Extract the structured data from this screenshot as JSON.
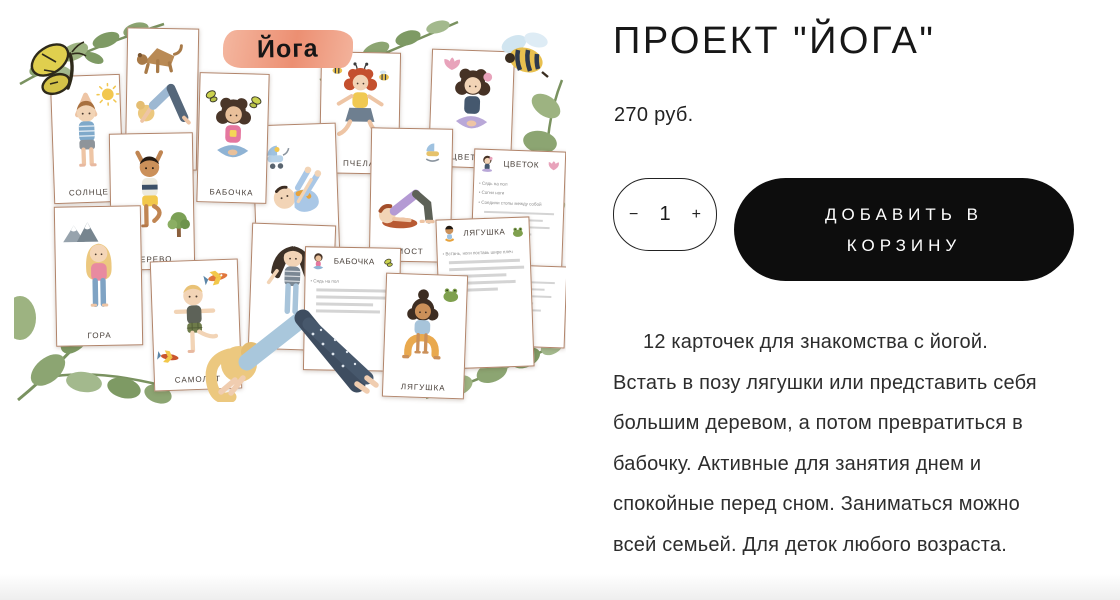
{
  "product": {
    "title": "ПРОЕКТ \"ЙОГА\"",
    "price": "270 руб.",
    "quantity": {
      "decrease_label": "−",
      "value": "1",
      "increase_label": "+"
    },
    "add_to_cart_label": "ДОБАВИТЬ В КОРЗИНУ",
    "description": "12 карточек для знакомства с йогой. Встать в позу лягушки или представить себя большим деревом, а потом превратиться в бабочку. Активные для занятия днем и спокойные перед сном. Заниматься можно всей семьей. Для деток любого возраста."
  },
  "product_image": {
    "banner_title": "Йога",
    "cards": {
      "solntse": {
        "label": "СОЛНЦЕ"
      },
      "sobaka": {
        "label": "СОБАКА"
      },
      "babochka": {
        "label": "БАБОЧКА"
      },
      "derevo": {
        "label": "ДЕРЕВО"
      },
      "gora": {
        "label": "ГОРА"
      },
      "samolyot": {
        "label": "САМОЛЁТ"
      },
      "most": {
        "label": "МОСТ"
      },
      "malysh": {
        "label": "МАЛЫШ"
      },
      "pchela": {
        "label": "ПЧЕЛА"
      },
      "tsvetok": {
        "label": "ЦВЕТОК"
      },
      "lyagushka": {
        "label": "ЛЯГУШКА"
      }
    },
    "instruction_cards": {
      "tsvetok": {
        "title": "ЦВЕТОК",
        "lines": [
          "Сядь на пол",
          "Согни ноги",
          "Соедини стопы между собой"
        ]
      },
      "lyagushka": {
        "title": "ЛЯГУШКА",
        "lines": [
          "Встань, ноги поставь шире плеч"
        ]
      },
      "babochka": {
        "title": "БАБОЧКА",
        "lines": [
          "Сядь на пол"
        ]
      }
    }
  },
  "colors": {
    "accent_button": "#0d0d0d",
    "card_border": "#b1846a",
    "banner": "#ec8f72",
    "leaf_green": "#8ca572"
  }
}
